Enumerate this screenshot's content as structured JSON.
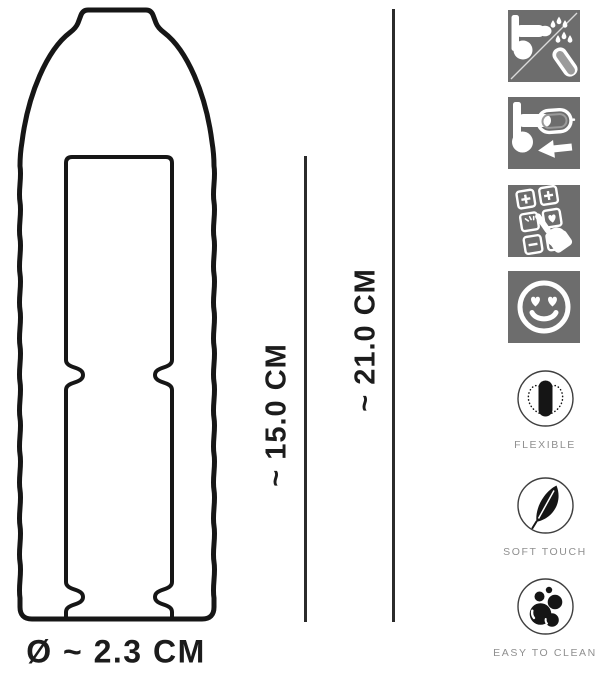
{
  "product_diagram": {
    "dimension_labels": {
      "insertable_length": "~ 15.0 CM",
      "total_length": "~ 21.0 CM",
      "diameter": "Ø ~ 2.3 CM"
    }
  },
  "pictograms": [
    {
      "icon": "lubricant-drops-and-sleeve-icon"
    },
    {
      "icon": "sleeve-pull-on-arrow-icon"
    },
    {
      "icon": "button-grid-hand-select-icon"
    },
    {
      "icon": "heart-eyes-smiley-icon"
    }
  ],
  "features": [
    {
      "icon": "flexible-bending-pill-icon",
      "label": "FLEXIBLE"
    },
    {
      "icon": "feather-icon",
      "label": "SOFT TOUCH"
    },
    {
      "icon": "bubbles-icon",
      "label": "EASY TO CLEAN"
    }
  ],
  "colors": {
    "outline": "#161616",
    "dimension_line": "#2b2b2b",
    "pictogram_background": "#6d6d6d",
    "pictogram_foreground": "#ffffff",
    "feature_ring": "#3f3f3f",
    "feature_icon": "#151515",
    "feature_label": "#8f8f8f",
    "text": "#1c1c1c"
  }
}
